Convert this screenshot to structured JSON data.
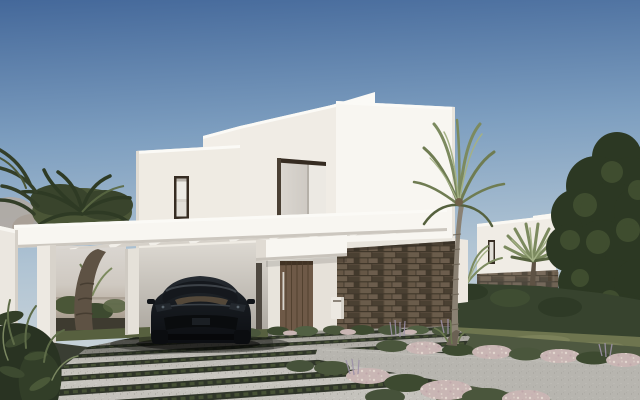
{
  "scene": {
    "kind": "exterior architectural render",
    "time": "daylight",
    "objects": {
      "sky": "clear gradient blue sky",
      "villa": "modern white stepped villa",
      "neighbor_house": "white house in background",
      "pergola": "white carport pergola",
      "car": "black luxury sedan parked under carport",
      "entrance_door": "vertical plank wood front door",
      "stone_wall": "dark stone clad base wall",
      "upper_window": "narrow dark framed window",
      "recessed_balcony": "tall recessed opening above entrance",
      "tall_palm": "tall slender palm tree",
      "carport_palm": "palm tree inside carport",
      "fan_palm": "small fan palm by neighbor house",
      "big_tree": "large dark green tree on right",
      "driveway": "concrete slab driveway with grass joints",
      "garden_path": "grey diagonal garden path",
      "flower_beds": "rows of pink-white flowers and green mounds",
      "hedge": "clipped dark hedge",
      "lawn": "olive green lawn",
      "boundary_wall": "white boundary wall on left",
      "shrubs_left": "dark foreground shrubs",
      "vista": "hazy distant view through carport"
    }
  },
  "palette": {
    "sky_top": "#44689A",
    "sky_mid": "#7E9FC0",
    "sky_low": "#AFC3D3",
    "sky_horizon": "#D6DBDC",
    "haze_top": "#DAD6D1",
    "haze_low": "#8F8578",
    "white_bright": "#FBFAF6",
    "white_lit": "#F8F6F1",
    "white_shade": "#F0ECE5",
    "white_dim": "#D6D1C9",
    "wall_ground": "#E8E4DC",
    "stone": "#5C4E3E",
    "wood_door": "#6E5947",
    "frame_dark": "#362C22",
    "recess_light": "#DCD8D2",
    "recess_mid": "#C6C1BA",
    "pave_lit": "#C8C6C0",
    "pave_shade": "#9C9992",
    "joint_green": "#2F3529",
    "joint_grass": "#4C5838",
    "path_grey": "#B7B5AF",
    "lawn": "#6E754F",
    "lawn_light": "#8A8F66",
    "lawn_dark": "#57603F",
    "hedge": "#37432E",
    "tree_dark": "#2C3823",
    "tree_light": "#465434",
    "palm_olive": "#7C8A5F",
    "palm_light": "#A4B186",
    "palm_dark": "#4A5536",
    "trunk_grey": "#8A8173",
    "trunk_dark": "#5E5244",
    "flower_pink": "#C9B6B4",
    "mound_green": "#4A563C",
    "lavender": "#9D92A8",
    "car_body_top": "#272C32",
    "car_body": "#0C0E12",
    "car_glass": "#15181D",
    "car_interior": "#6E5B44",
    "shadow": "#141612"
  }
}
